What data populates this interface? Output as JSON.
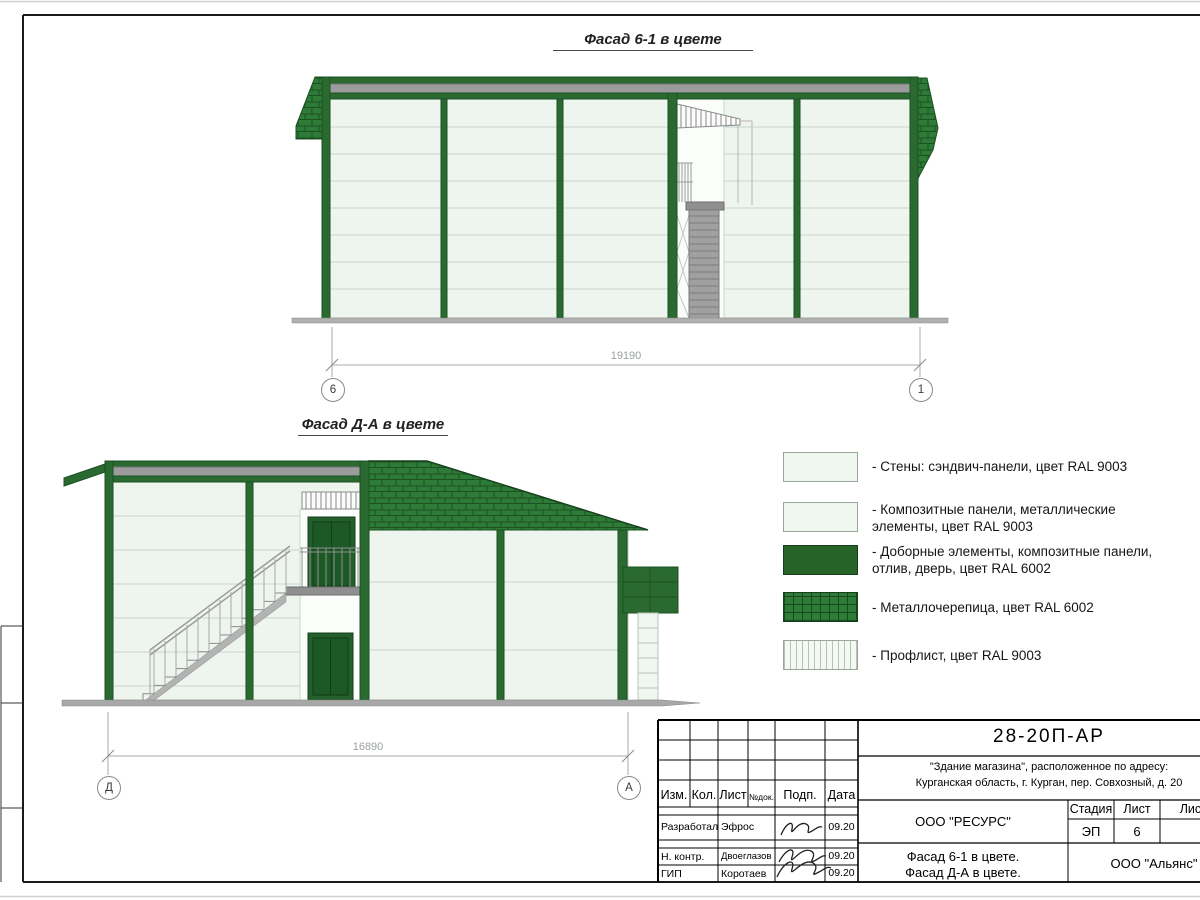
{
  "page": {
    "facade1_title": "Фасад 6-1 в цвете",
    "facade2_title": "Фасад Д-А в цвете",
    "watermark": "строительная"
  },
  "dims": {
    "f1": {
      "value": "19190",
      "left_axis": "6",
      "right_axis": "1"
    },
    "f2": {
      "value": "16890",
      "left_axis": "Д",
      "right_axis": "А"
    }
  },
  "legend": {
    "items": [
      {
        "name": "walls-sandwich-panels",
        "label": "- Стены: сэндвич-панели, цвет RAL 9003",
        "swatch": "light"
      },
      {
        "name": "composite-panels",
        "label": "- Композитные панели, металлические элементы, цвет RAL 9003",
        "swatch": "light"
      },
      {
        "name": "trim-elements",
        "label": "- Доборные элементы,  композитные панели, отлив, дверь, цвет RAL 6002",
        "swatch": "green"
      },
      {
        "name": "metal-roof-tile",
        "label": "- Металлочерепица, цвет RAL 6002",
        "swatch": "shingle"
      },
      {
        "name": "profiled-sheet",
        "label": "- Профлист, цвет RAL 9003",
        "swatch": "proflist"
      }
    ]
  },
  "title_block": {
    "doc_number": "28-20П-АР",
    "project_line1": "\"Здание магазина\", расположенное по адресу:",
    "project_line2": "Курганская область, г. Курган, пер. Совхозный, д. 20",
    "cols": {
      "izm": "Изм.",
      "kol": "Кол.",
      "list": "Лист",
      "ndok": "№док.",
      "podp": "Подп.",
      "data": "Дата"
    },
    "rows": [
      {
        "role": "Разработал",
        "name": "Эфрос",
        "date": "09.20"
      },
      {
        "role": "Н. контр.",
        "name": "Двоеглазов",
        "date": "09.20"
      },
      {
        "role": "ГИП",
        "name": "Коротаев",
        "date": "09.20"
      }
    ],
    "org": "ООО \"РЕСУРС\"",
    "sheet_name_line1": "Фасад 6-1 в цвете.",
    "sheet_name_line2": "Фасад Д-А в цвете.",
    "stage_label": "Стадия",
    "stage_value": "ЭП",
    "sheet_label": "Лист",
    "sheet_value": "6",
    "sheets_label": "Листов",
    "contractor": "ООО \"Альянс\""
  },
  "colors": {
    "frame_green": "#2a6a31",
    "frame_green_dark": "#1c5023",
    "roof_green": "#2e7b37",
    "wall_light": "#eef5ee",
    "flashing_gray": "#9c9c9c"
  }
}
